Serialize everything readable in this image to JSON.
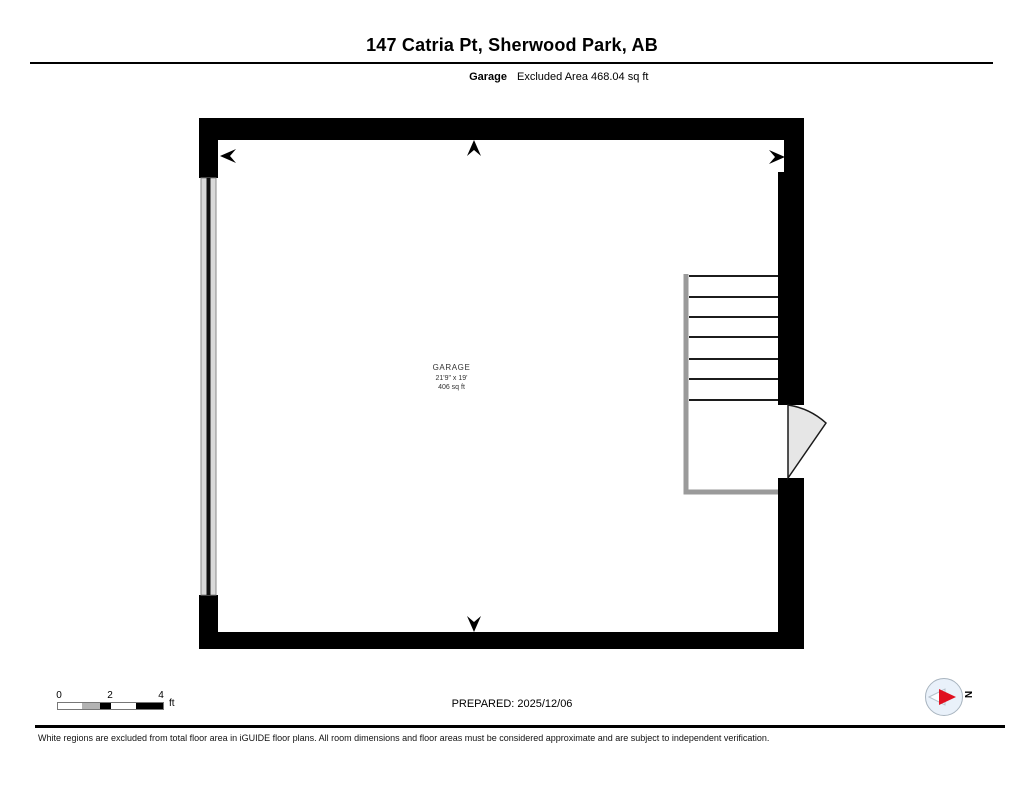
{
  "header": {
    "title": "147 Catria Pt, Sherwood Park, AB",
    "room_name": "Garage",
    "excluded_area": "Excluded Area 468.04 sq ft"
  },
  "floorplan": {
    "room_label": {
      "name": "GARAGE",
      "dimensions": "21'9\" x 19'",
      "area": "406 sq ft"
    }
  },
  "footer": {
    "scale": {
      "tick_labels": [
        "0",
        "2",
        "4"
      ],
      "unit": "ft"
    },
    "prepared": "PREPARED: 2025/12/06",
    "compass": {
      "label": "N",
      "needle_color": "#e01020"
    },
    "disclaimer": "White regions are excluded from total floor area in iGUIDE floor plans. All room dimensions and floor areas must be considered approximate and are subject to independent verification."
  }
}
